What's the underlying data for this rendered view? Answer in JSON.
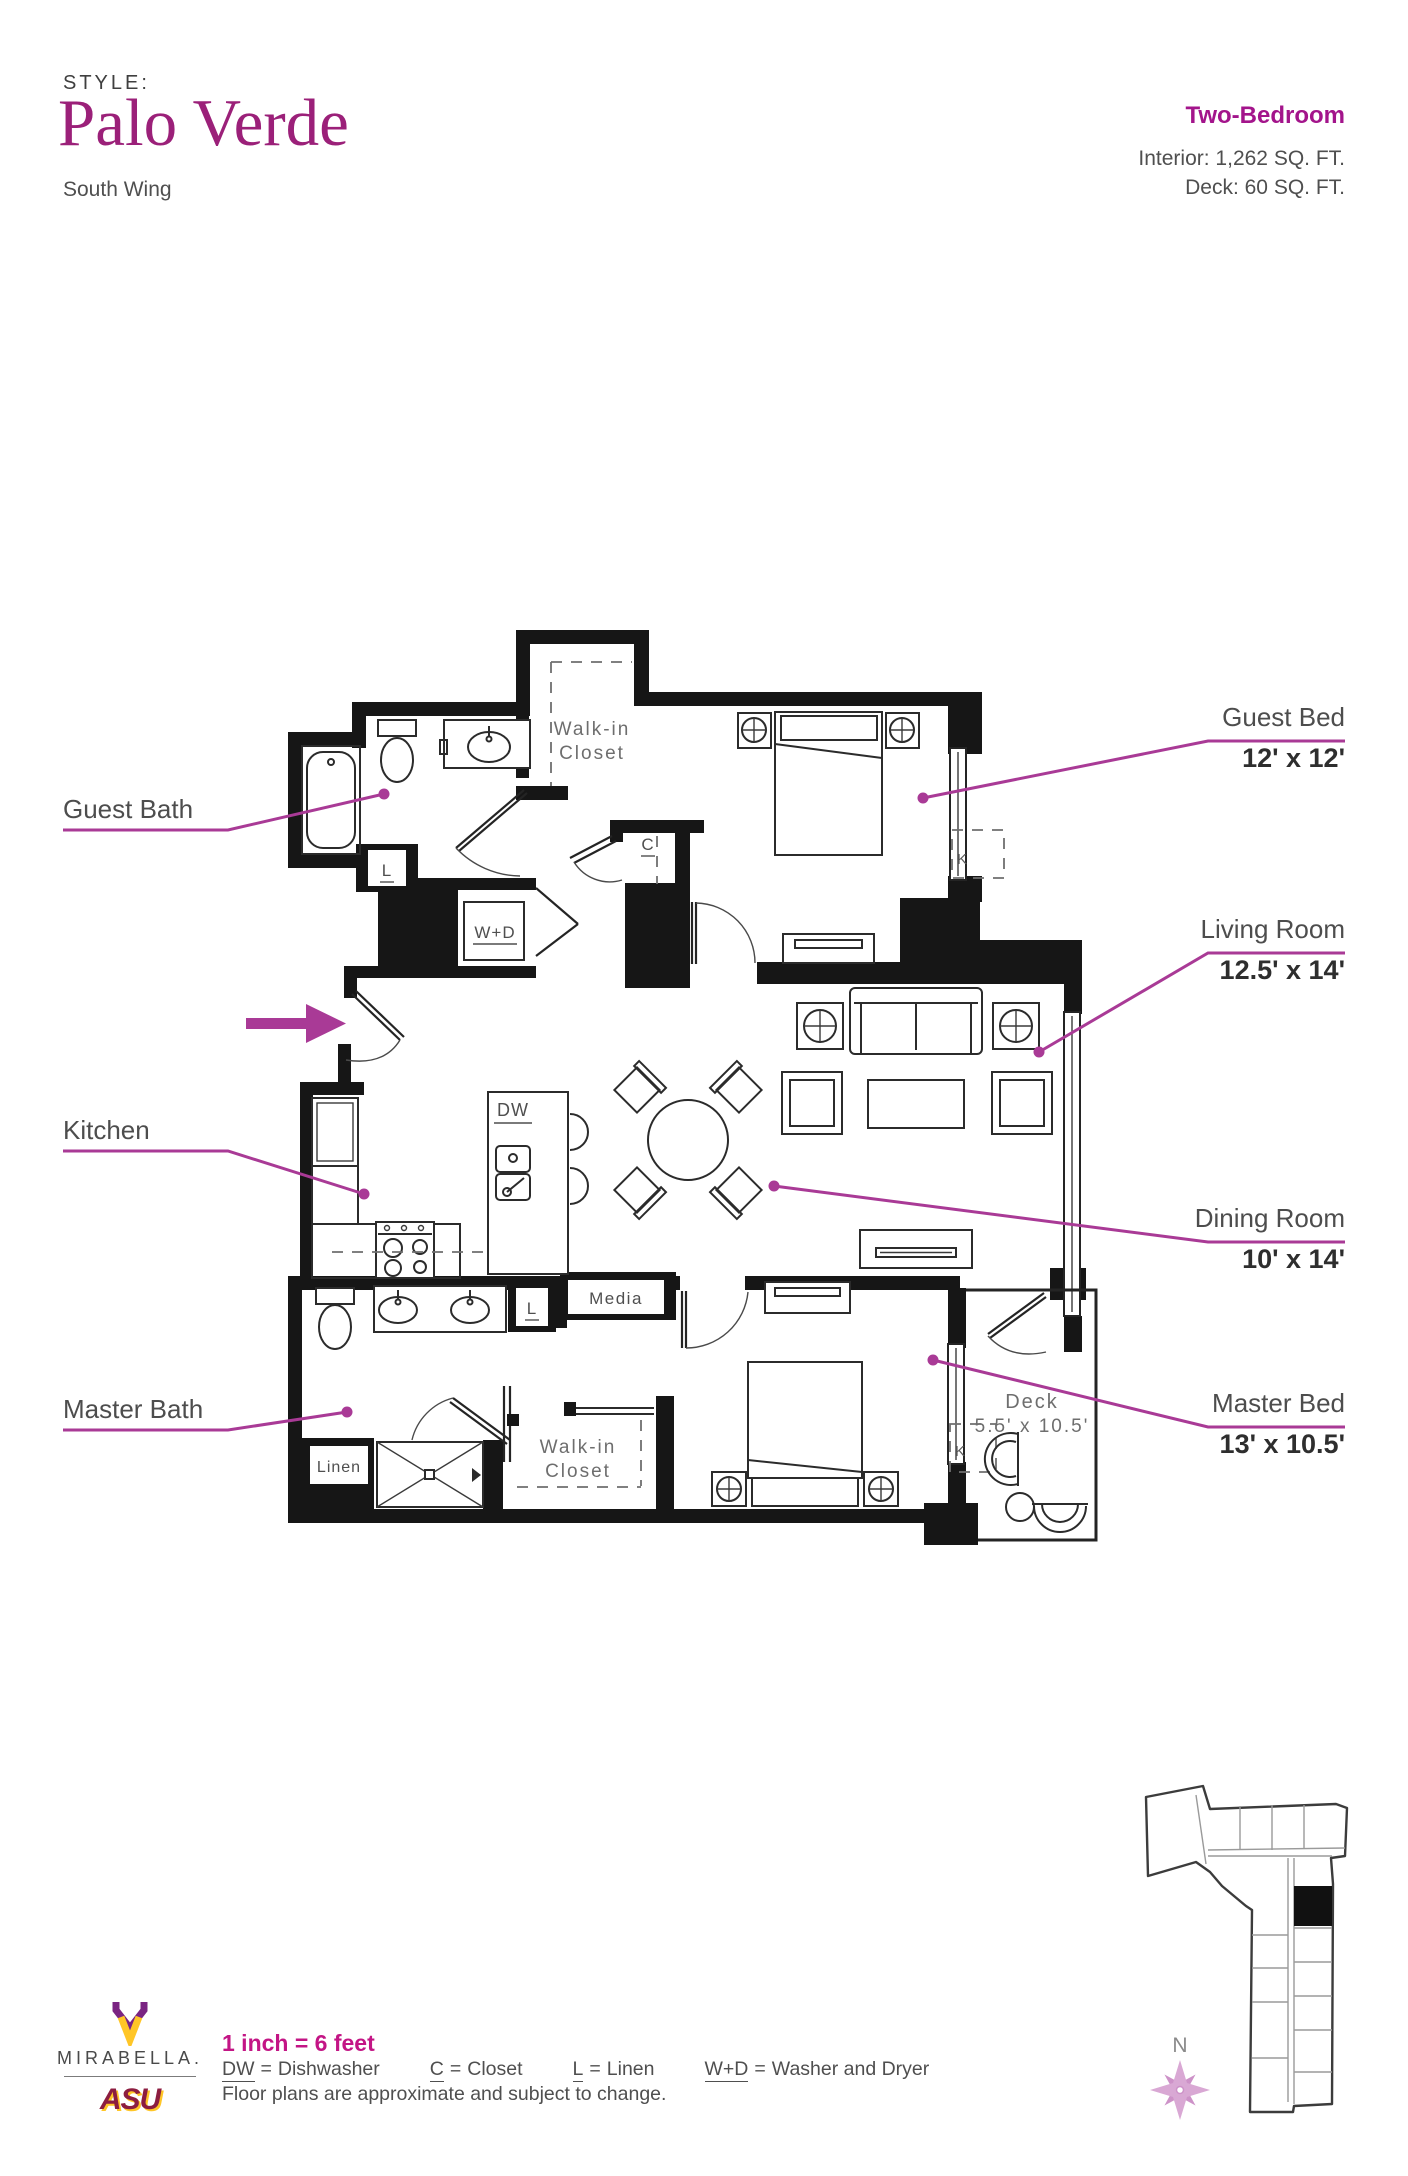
{
  "header": {
    "style_label": "STYLE:",
    "title": "Palo Verde",
    "subtitle": "South Wing"
  },
  "summary": {
    "type": "Two-Bedroom",
    "interior": "Interior: 1,262 SQ. FT.",
    "deck": "Deck: 60 SQ. FT."
  },
  "callouts": {
    "guest_bed": {
      "label": "Guest Bed",
      "dims": "12' x 12'"
    },
    "living_room": {
      "label": "Living Room",
      "dims": "12.5' x 14'"
    },
    "dining_room": {
      "label": "Dining Room",
      "dims": "10' x 14'"
    },
    "master_bed": {
      "label": "Master Bed",
      "dims": "13' x 10.5'"
    },
    "guest_bath": {
      "label": "Guest Bath"
    },
    "kitchen": {
      "label": "Kitchen"
    },
    "master_bath": {
      "label": "Master Bath"
    }
  },
  "plan": {
    "walk_in": "Walk-in",
    "closet": "Closet",
    "wd": "W+D",
    "dw": "DW",
    "c": "C",
    "l": "L",
    "media": "Media",
    "linen": "Linen",
    "deck": "Deck",
    "deck_dims": "5.5' x 10.5'",
    "window_k": "K"
  },
  "legend": {
    "scale": "1 inch = 6 feet",
    "eq": "=",
    "items": [
      {
        "abbr": "DW",
        "desc": "Dishwasher"
      },
      {
        "abbr": "C",
        "desc": "Closet"
      },
      {
        "abbr": "L",
        "desc": "Linen"
      },
      {
        "abbr": "W+D",
        "desc": "Washer and Dryer"
      }
    ],
    "disclaimer": "Floor plans are approximate and subject to change."
  },
  "branding": {
    "mirabella": "MIRABELLA.",
    "asu": "ASU"
  },
  "sitemap": {
    "north_label": "N"
  },
  "colors": {
    "accent": "#A3148B",
    "title": "#9B2079",
    "leader": "#A93A96",
    "scale_text": "#C31585",
    "wall": "#161616",
    "plan_label": "#6e6e6e",
    "compass": "#D9A8D4",
    "compass2": "#CD92C8",
    "asu_maroon": "#8C1D40",
    "asu_gold": "#FFC627",
    "mirabella_purple": "#7A2482"
  }
}
